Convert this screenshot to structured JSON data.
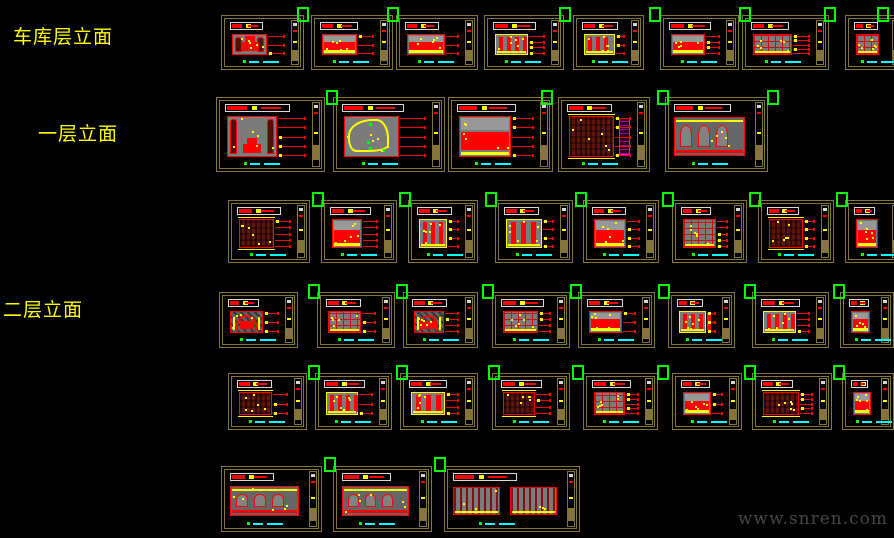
{
  "labels": {
    "garage": "车库层立面",
    "first_floor": "一层立面",
    "second_floor": "二层立面"
  },
  "watermark": "www.snren.com",
  "palette": {
    "background": "#000000",
    "frame": "#85753a",
    "red": "#ff0000",
    "yellow": "#ffff00",
    "gray": "#7b7b7b",
    "white": "#d8d8d8",
    "cyan": "#00ffff",
    "green": "#00ff00",
    "magenta": "#ff00ff",
    "label_yellow": "#ffff00",
    "watermark_gray": "#474747"
  },
  "rows": [
    {
      "name": "row-garage-elevations",
      "section": "garage",
      "y": 15,
      "h": 55,
      "panels": [
        {
          "x": 221,
          "w": 83,
          "v": "cols"
        },
        {
          "x": 311,
          "w": 82,
          "v": "solid"
        },
        {
          "x": 396,
          "w": 82,
          "v": "solid"
        },
        {
          "x": 484,
          "w": 80,
          "v": "bars"
        },
        {
          "x": 573,
          "w": 71,
          "v": "bars"
        },
        {
          "x": 660,
          "w": 79,
          "v": "solid"
        },
        {
          "x": 742,
          "w": 87,
          "v": "grid"
        },
        {
          "x": 845,
          "w": 60,
          "v": "grid"
        }
      ]
    },
    {
      "name": "row-first-floor-elevations-a",
      "section": "first_floor",
      "y": 97,
      "h": 75,
      "panels": [
        {
          "x": 216,
          "w": 109,
          "v": "cols"
        },
        {
          "x": 333,
          "w": 112,
          "v": "curve"
        },
        {
          "x": 448,
          "w": 105,
          "v": "solid"
        },
        {
          "x": 558,
          "w": 92,
          "v": "hatch",
          "accent": "magenta"
        },
        {
          "x": 665,
          "w": 103,
          "v": "wide"
        }
      ]
    },
    {
      "name": "row-first-floor-elevations-b",
      "section": "first_floor",
      "y": 200,
      "h": 63,
      "panels": [
        {
          "x": 228,
          "w": 82,
          "v": "hatch"
        },
        {
          "x": 321,
          "w": 76,
          "v": "solid"
        },
        {
          "x": 408,
          "w": 70,
          "v": "bars"
        },
        {
          "x": 495,
          "w": 78,
          "v": "bars"
        },
        {
          "x": 583,
          "w": 76,
          "v": "solid"
        },
        {
          "x": 672,
          "w": 75,
          "v": "grid"
        },
        {
          "x": 758,
          "w": 76,
          "v": "hatch"
        },
        {
          "x": 845,
          "w": 60,
          "v": "solid"
        }
      ]
    },
    {
      "name": "row-second-floor-elevations-a",
      "section": "second_floor",
      "y": 292,
      "h": 56,
      "panels": [
        {
          "x": 219,
          "w": 79,
          "v": "arch"
        },
        {
          "x": 317,
          "w": 78,
          "v": "grid"
        },
        {
          "x": 403,
          "w": 75,
          "v": "arch"
        },
        {
          "x": 492,
          "w": 78,
          "v": "grid"
        },
        {
          "x": 578,
          "w": 77,
          "v": "solid"
        },
        {
          "x": 668,
          "w": 67,
          "v": "bars"
        },
        {
          "x": 752,
          "w": 77,
          "v": "bars"
        },
        {
          "x": 840,
          "w": 54,
          "v": "solid"
        }
      ]
    },
    {
      "name": "row-second-floor-elevations-b",
      "section": "second_floor",
      "y": 373,
      "h": 57,
      "panels": [
        {
          "x": 228,
          "w": 79,
          "v": "hatch"
        },
        {
          "x": 315,
          "w": 77,
          "v": "bars"
        },
        {
          "x": 400,
          "w": 78,
          "v": "bars"
        },
        {
          "x": 492,
          "w": 78,
          "v": "hatch"
        },
        {
          "x": 583,
          "w": 75,
          "v": "grid"
        },
        {
          "x": 672,
          "w": 70,
          "v": "solid"
        },
        {
          "x": 752,
          "w": 80,
          "v": "hatch"
        },
        {
          "x": 842,
          "w": 52,
          "v": "solid"
        }
      ]
    },
    {
      "name": "row-second-floor-elevations-c",
      "section": "second_floor",
      "y": 466,
      "h": 66,
      "panels": [
        {
          "x": 221,
          "w": 101,
          "v": "wide"
        },
        {
          "x": 333,
          "w": 99,
          "v": "wide"
        },
        {
          "x": 444,
          "w": 136,
          "v": "twin"
        }
      ]
    }
  ],
  "markers": [
    [
      297,
      7
    ],
    [
      387,
      7
    ],
    [
      559,
      7
    ],
    [
      649,
      7
    ],
    [
      739,
      7
    ],
    [
      824,
      7
    ],
    [
      877,
      7
    ],
    [
      326,
      90
    ],
    [
      541,
      90
    ],
    [
      657,
      90
    ],
    [
      767,
      90
    ],
    [
      312,
      192
    ],
    [
      399,
      192
    ],
    [
      485,
      192
    ],
    [
      575,
      192
    ],
    [
      662,
      192
    ],
    [
      749,
      192
    ],
    [
      836,
      192
    ],
    [
      308,
      284
    ],
    [
      396,
      284
    ],
    [
      482,
      284
    ],
    [
      570,
      284
    ],
    [
      658,
      284
    ],
    [
      744,
      284
    ],
    [
      833,
      284
    ],
    [
      308,
      365
    ],
    [
      396,
      365
    ],
    [
      488,
      365
    ],
    [
      572,
      365
    ],
    [
      657,
      365
    ],
    [
      744,
      365
    ],
    [
      833,
      365
    ],
    [
      324,
      457
    ],
    [
      434,
      457
    ]
  ]
}
